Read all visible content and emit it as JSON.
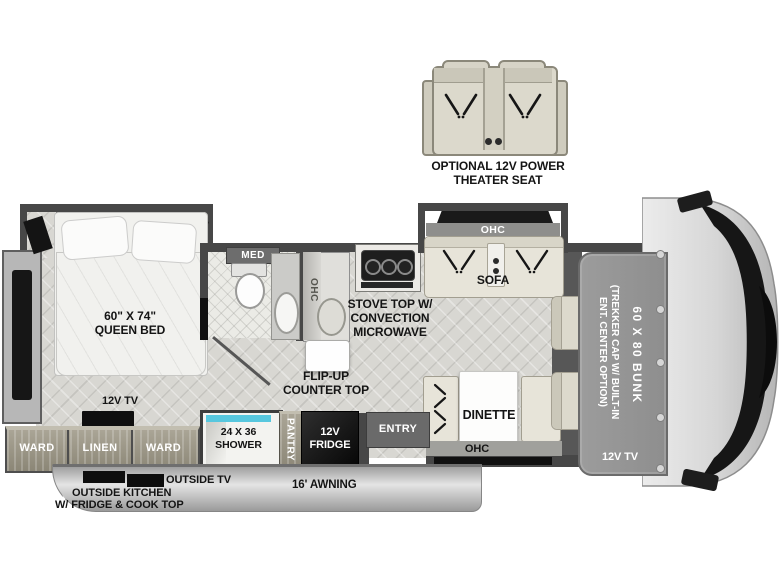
{
  "colors": {
    "wall": "#474747",
    "floor": "#d8d7d2",
    "cabinet": "#9a9585",
    "cushion": "#e7e4d9",
    "window": "#141414",
    "shower_accent": "#57c7de"
  },
  "theater_seat": {
    "label_line1": "OPTIONAL 12V POWER",
    "label_line2": "THEATER SEAT"
  },
  "bedroom": {
    "bed_size": "60\" X 74\"",
    "bed_name": "QUEEN BED",
    "tv": "12V TV",
    "ward_left": "WARD",
    "linen": "LINEN",
    "ward_right": "WARD"
  },
  "bath": {
    "med": "MED",
    "shower_line1": "24 X 36",
    "shower_line2": "SHOWER"
  },
  "kitchen": {
    "ohc": "OHC",
    "stove_line1": "STOVE TOP W/",
    "stove_line2": "CONVECTION",
    "stove_line3": "MICROWAVE",
    "flip_line1": "FLIP-UP",
    "flip_line2": "COUNTER TOP",
    "pantry": "PANTRY",
    "fridge_line1": "12V",
    "fridge_line2": "FRIDGE"
  },
  "living": {
    "sofa_ohc": "OHC",
    "sofa": "SOFA",
    "dinette": "DINETTE",
    "dinette_ohc": "OHC",
    "entry": "ENTRY"
  },
  "cab": {
    "trekker_line1": "(TREKKER CAP W/ BUILT-IN",
    "trekker_line2": "ENT. CENTER OPTION)",
    "bunk": "60 X 80 BUNK",
    "tv": "12V TV"
  },
  "exterior": {
    "outside_tv": "OUTSIDE TV",
    "outside_kitchen_line1": "OUTSIDE KITCHEN",
    "outside_kitchen_line2": "W/ FRIDGE & COOK TOP",
    "awning": "16' AWNING"
  }
}
